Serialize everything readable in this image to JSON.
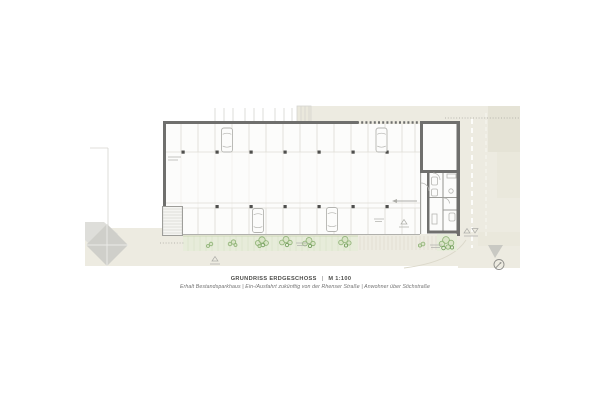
{
  "sheet": {
    "title": "GRUNDRISS ERDGESCHOSS",
    "title_separator": "|",
    "scale": "M 1:100",
    "subtitle_line": "Erhalt Bestandsparkhaus | Ein-/Ausfahrt zukünftig von der Rhenser Straße | Anwohner über Stichstraße"
  },
  "icons": {
    "north_arrow": "compass-circle-with-pointer",
    "site_markers": "small-triangle-survey-marks"
  },
  "colors": {
    "ground": "#edebe1",
    "ground2": "#e5e3d6",
    "ground3": "#eae8dc",
    "paving": "#dbd8ca",
    "wedge": "#c9c9c3",
    "dotted": "#a5a59d",
    "dashMain": "#ffffff",
    "dashSoft": "#f6f5ee",
    "ctx": "#d6d5d0",
    "roof": "#cfcfca",
    "roofLight": "#dededa",
    "roofLine": "#ebebe8",
    "interior": "#fcfcfb",
    "grid": "#eceae6",
    "stall": "#deddd6",
    "bottomEdge": "#b0b0ac",
    "wall": "#6f6f6d",
    "wallLight": "#9d9d99",
    "column": "#4f4f4d",
    "tread": "#c8c8c4",
    "stairFill": "#f5f5f2",
    "fixture": "#b6b6b2",
    "car": "#b4b4b0",
    "vegFill": "#e7ecda",
    "vegHatch": "#d8e2c6",
    "vegEdge": "#c3d1ab",
    "plant": "#8cb173",
    "plantDark": "#6e9c57",
    "plantFill": "#cfe0ba",
    "marker": "#adada8",
    "label": "#b3b3af",
    "north": "#8f8f8b",
    "titleText": "#4c4c4a",
    "subtitleText": "#707070"
  }
}
